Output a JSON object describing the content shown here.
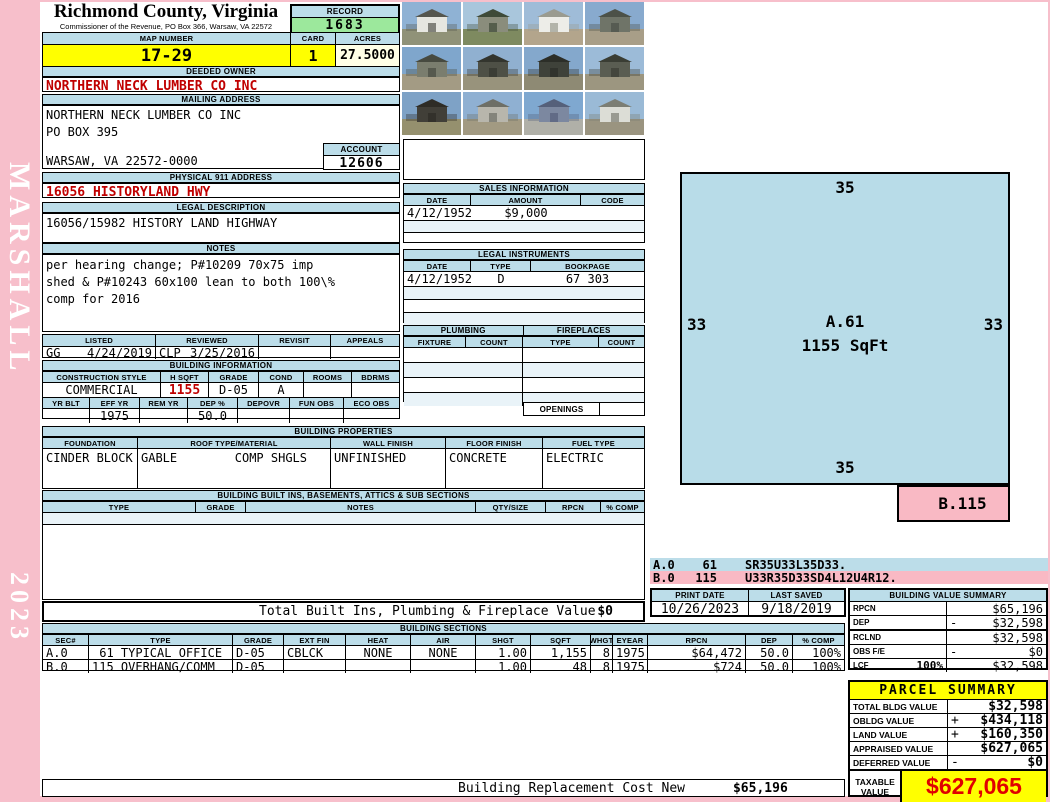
{
  "county": {
    "title": "Richmond County, Virginia",
    "subtitle": "Commissioner of the Revenue, PO Box 366, Warsaw, VA 22572"
  },
  "sidebar": {
    "name": "MARSHALL",
    "year": "2023"
  },
  "record": {
    "label": "RECORD",
    "value": "1683"
  },
  "map": {
    "map_number_label": "MAP NUMBER",
    "map_number": "17-29",
    "card_label": "CARD",
    "card": "1",
    "acres_label": "ACRES",
    "acres": "27.5000"
  },
  "owner": {
    "header": "DEEDED OWNER",
    "name": "NORTHERN NECK LUMBER CO INC"
  },
  "mailing": {
    "header": "MAILING ADDRESS",
    "line1": "NORTHERN NECK LUMBER CO INC",
    "line2": "PO BOX 395",
    "line3": "WARSAW, VA 22572-0000",
    "account_label": "ACCOUNT",
    "account": "12606"
  },
  "physical": {
    "header": "PHYSICAL 911 ADDRESS",
    "value": "16056 HISTORYLAND HWY"
  },
  "legal": {
    "header": "LEGAL DESCRIPTION",
    "value": "16056/15982 HISTORY LAND HIGHWAY"
  },
  "notes": {
    "header": "NOTES",
    "line1": "per hearing change; P#10209 70x75 imp",
    "line2": "shed & P#10243 60x100 lean to both 100\\%",
    "line3": "comp for 2016"
  },
  "review": {
    "headers": [
      "LISTED",
      "REVIEWED",
      "REVISIT",
      "APPEALS"
    ],
    "listed_by": "GG",
    "listed_date": "4/24/2019",
    "reviewed_by": "CLP",
    "reviewed_date": "3/25/2016",
    "revisit": "",
    "appeals": ""
  },
  "building_info": {
    "header": "BUILDING INFORMATION",
    "r1h": [
      "CONSTRUCTION STYLE",
      "H SQFT",
      "GRADE",
      "COND",
      "ROOMS",
      "BDRMS"
    ],
    "r1v": [
      "COMMERCIAL",
      "1155",
      "D-05",
      "A",
      "",
      ""
    ],
    "r2h": [
      "YR BLT",
      "EFF YR",
      "REM YR",
      "DEP %",
      "DEPOVR",
      "FUN OBS",
      "ECO OBS"
    ],
    "r2v": [
      "",
      "1975",
      "",
      "50.0",
      "",
      "",
      ""
    ]
  },
  "building_props": {
    "header": "BUILDING PROPERTIES",
    "h": [
      "FOUNDATION",
      "ROOF TYPE/MATERIAL",
      "WALL FINISH",
      "FLOOR FINISH",
      "FUEL TYPE"
    ],
    "foundation": "CINDER BLOCK",
    "roof_type": "GABLE",
    "roof_material": "COMP SHGLS",
    "wall": "UNFINISHED",
    "floor": "CONCRETE",
    "fuel": "ELECTRIC"
  },
  "built_ins": {
    "header": "BUILDING BUILT INS, BASEMENTS, ATTICS & SUB SECTIONS",
    "h": [
      "TYPE",
      "GRADE",
      "NOTES",
      "QTY/SIZE",
      "RPCN",
      "% COMP"
    ]
  },
  "totals": {
    "built_ins_label": "Total Built Ins, Plumbing & Fireplace Value",
    "built_ins_value": "$0",
    "replacement_label": "Building Replacement Cost New",
    "replacement_value": "$65,196"
  },
  "sales": {
    "header": "SALES INFORMATION",
    "h": [
      "DATE",
      "AMOUNT",
      "CODE"
    ],
    "date": "4/12/1952",
    "amount": "$9,000",
    "code": ""
  },
  "instruments": {
    "header": "LEGAL INSTRUMENTS",
    "h": [
      "DATE",
      "TYPE",
      "BOOKPAGE"
    ],
    "date": "4/12/1952",
    "type": "D",
    "bookpage": "67 303"
  },
  "plumbing": {
    "header": "PLUMBING",
    "h": [
      "FIXTURE",
      "COUNT"
    ]
  },
  "fireplaces": {
    "header": "FIREPLACES",
    "h": [
      "TYPE",
      "COUNT"
    ],
    "openings_label": "OPENINGS"
  },
  "sketch": {
    "top": "35",
    "bottom": "35",
    "left": "33",
    "right": "33",
    "section_label": "A.61",
    "sqft": "1155 SqFt",
    "b_label": "B.115"
  },
  "vectors": {
    "a": {
      "sec": "A.0",
      "num": "61",
      "path": "SR35U33L35D33."
    },
    "b": {
      "sec": "B.0",
      "num": "115",
      "path": "U33R35D33SD4L12U4R12."
    }
  },
  "print_info": {
    "print_date_label": "PRINT DATE",
    "print_date": "10/26/2023",
    "last_saved_label": "LAST SAVED",
    "last_saved": "9/18/2019"
  },
  "value_summary": {
    "header": "BUILDING VALUE SUMMARY",
    "rows": [
      {
        "label": "RPCN",
        "pct": "",
        "op": "",
        "value": "$65,196"
      },
      {
        "label": "DEP",
        "pct": "",
        "op": "-",
        "value": "$32,598"
      },
      {
        "label": "RCLND",
        "pct": "",
        "op": "",
        "value": "$32,598"
      },
      {
        "label": "OBS F/E",
        "pct": "",
        "op": "-",
        "value": "$0"
      },
      {
        "label": "LCF",
        "pct": "100%",
        "op": "",
        "value": "$32,598"
      }
    ]
  },
  "building_sections": {
    "header": "BUILDING SECTIONS",
    "h": [
      "SEC#",
      "TYPE",
      "GRADE",
      "EXT FIN",
      "HEAT",
      "AIR",
      "SHGT",
      "SQFT",
      "WHGT",
      "EYEAR",
      "RPCN",
      "DEP",
      "% COMP"
    ],
    "rows": [
      {
        "sec": "A.0",
        "type": " 61 TYPICAL OFFICE",
        "grade": "D-05",
        "ext": "CBLCK",
        "heat": "NONE",
        "air": "NONE",
        "shgt": "1.00",
        "sqft": "1,155",
        "whgt": "8",
        "eyear": "1975",
        "rpcn": "$64,472",
        "dep": "50.0",
        "comp": "100%"
      },
      {
        "sec": "B.0",
        "type": "115 OVERHANG/COMM",
        "grade": "D-05",
        "ext": "",
        "heat": "",
        "air": "",
        "shgt": "1.00",
        "sqft": "48",
        "whgt": "8",
        "eyear": "1975",
        "rpcn": "$724",
        "dep": "50.0",
        "comp": "100%"
      }
    ]
  },
  "parcel_summary": {
    "header": "PARCEL SUMMARY",
    "rows": [
      {
        "label": "TOTAL BLDG VALUE",
        "op": "",
        "value": "$32,598"
      },
      {
        "label": "OBLDG VALUE",
        "op": "+",
        "value": "$434,118"
      },
      {
        "label": "LAND VALUE",
        "op": "+",
        "value": "$160,350"
      },
      {
        "label": "APPRAISED VALUE",
        "op": "",
        "value": "$627,065"
      },
      {
        "label": "DEFERRED VALUE",
        "op": "-",
        "value": "$0"
      }
    ],
    "taxable_label": "TAXABLE VALUE",
    "taxable_value": "$627,065"
  },
  "colors": {
    "accent_red": "#C00000",
    "header_blue": "#BCDDE9",
    "highlight_yellow": "#FFFF00",
    "record_green": "#9CE89C",
    "acres_cream": "#FFFFE6",
    "sketch_blue": "#B8DCE8",
    "sketch_pink": "#F9B9C4",
    "margin_pink": "#F7BFCB"
  },
  "photos": {
    "count": 12,
    "tiles": [
      {
        "sky": "#8FB2D4",
        "ground": "#909278",
        "bldg": "#E6E6E0",
        "roof": "#55564E"
      },
      {
        "sky": "#A9C6DC",
        "ground": "#7E8A60",
        "bldg": "#8A8D7C",
        "roof": "#3E4A38"
      },
      {
        "sky": "#9FBCD8",
        "ground": "#B3A58C",
        "bldg": "#EDEDE8",
        "roof": "#9A9B90"
      },
      {
        "sky": "#88AACE",
        "ground": "#A89E88",
        "bldg": "#6F7468",
        "roof": "#4C5148"
      },
      {
        "sky": "#7FA6CC",
        "ground": "#A39B84",
        "bldg": "#7A7D6E",
        "roof": "#474A40"
      },
      {
        "sky": "#90B0D0",
        "ground": "#98937C",
        "bldg": "#4E5046",
        "roof": "#33352E"
      },
      {
        "sky": "#84A8CC",
        "ground": "#8E8A74",
        "bldg": "#3F423A",
        "roof": "#2C2E28"
      },
      {
        "sky": "#9CBBD8",
        "ground": "#9C9680",
        "bldg": "#5A5D52",
        "roof": "#3A3D34"
      },
      {
        "sky": "#7EA2C6",
        "ground": "#95906E",
        "bldg": "#413F38",
        "roof": "#2E2C26"
      },
      {
        "sky": "#8FB0D2",
        "ground": "#A29A82",
        "bldg": "#B8B6AC",
        "roof": "#6E6F66"
      },
      {
        "sky": "#7FA8D0",
        "ground": "#B0B0A8",
        "bldg": "#7C88A0",
        "roof": "#55607A"
      },
      {
        "sky": "#9ABAD6",
        "ground": "#9A9480",
        "bldg": "#DCDDD6",
        "roof": "#7C7E74"
      }
    ]
  }
}
